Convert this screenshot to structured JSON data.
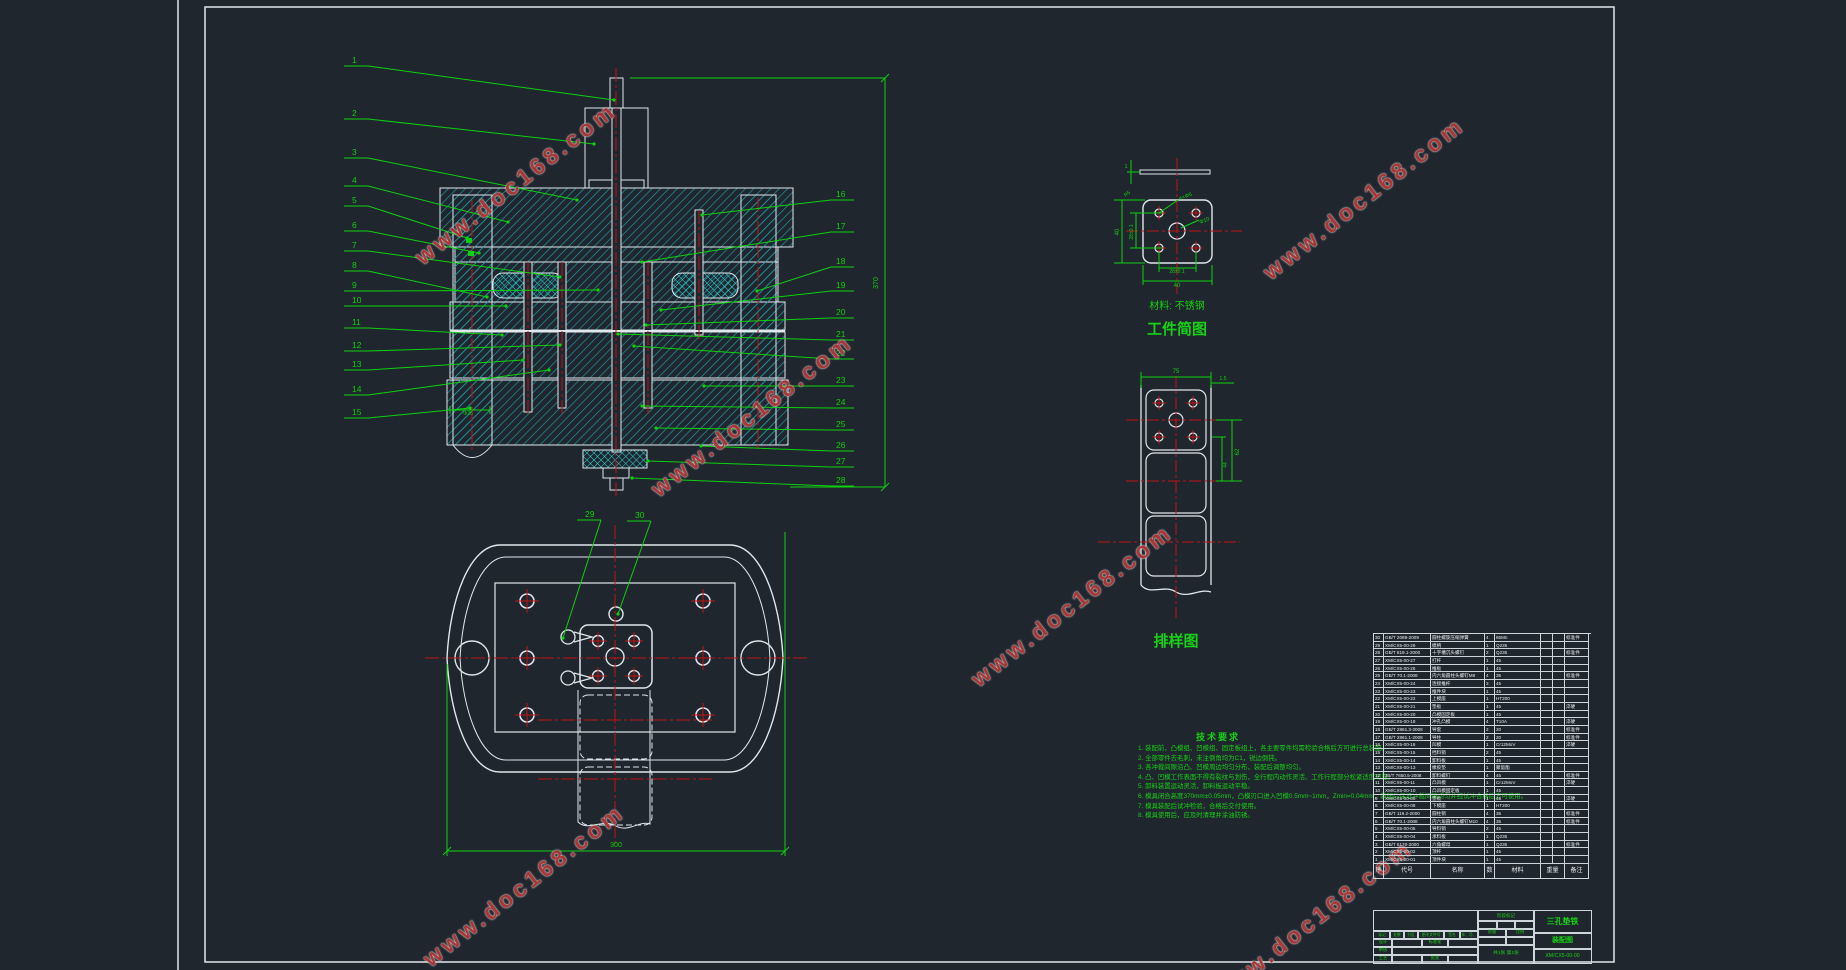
{
  "colors": {
    "bg": "#20262e",
    "line_white": "#dfe7ec",
    "annot_green": "#0ed10e",
    "center_red": "#c01414",
    "hatch_teal": "#1d97a3",
    "hatch_cyan": "#2fd8dc",
    "watermark_red": "#a83838"
  },
  "watermark": {
    "text": "www.doc168.com",
    "positions": [
      {
        "x": 392,
        "y": 170,
        "rot": -38
      },
      {
        "x": 1240,
        "y": 185,
        "rot": -38
      },
      {
        "x": 628,
        "y": 402,
        "rot": -38
      },
      {
        "x": 948,
        "y": 592,
        "rot": -38
      },
      {
        "x": 400,
        "y": 872,
        "rot": -38
      },
      {
        "x": 1188,
        "y": 908,
        "rot": -38
      }
    ]
  },
  "views": {
    "workpiece": {
      "material_note": "材料: 不锈钢",
      "title": "工件简图"
    },
    "layout": {
      "title": "排样图"
    }
  },
  "leaders": {
    "left": [
      {
        "n": "1",
        "lx": 352,
        "ly": 63,
        "tx": 614,
        "ty": 100
      },
      {
        "n": "2",
        "lx": 352,
        "ly": 116,
        "tx": 594,
        "ty": 144
      },
      {
        "n": "3",
        "lx": 352,
        "ly": 155,
        "tx": 577,
        "ty": 200
      },
      {
        "n": "4",
        "lx": 352,
        "ly": 183,
        "tx": 508,
        "ty": 222
      },
      {
        "n": "5",
        "lx": 352,
        "ly": 203,
        "tx": 467,
        "ty": 238
      },
      {
        "n": "6",
        "lx": 352,
        "ly": 228,
        "tx": 479,
        "ty": 253
      },
      {
        "n": "7",
        "lx": 352,
        "ly": 248,
        "tx": 560,
        "ty": 277
      },
      {
        "n": "8",
        "lx": 352,
        "ly": 268,
        "tx": 487,
        "ty": 297
      },
      {
        "n": "9",
        "lx": 352,
        "ly": 288,
        "tx": 598,
        "ty": 290
      },
      {
        "n": "10",
        "lx": 352,
        "ly": 303,
        "tx": 506,
        "ty": 306
      },
      {
        "n": "11",
        "lx": 352,
        "ly": 325,
        "tx": 502,
        "ty": 335
      },
      {
        "n": "12",
        "lx": 352,
        "ly": 348,
        "tx": 560,
        "ty": 345
      },
      {
        "n": "13",
        "lx": 352,
        "ly": 367,
        "tx": 523,
        "ty": 360
      },
      {
        "n": "14",
        "lx": 352,
        "ly": 392,
        "tx": 549,
        "ty": 370
      },
      {
        "n": "15",
        "lx": 352,
        "ly": 415,
        "tx": 470,
        "ty": 408
      }
    ],
    "right": [
      {
        "n": "16",
        "lx": 836,
        "ly": 197,
        "tx": 702,
        "ty": 215
      },
      {
        "n": "17",
        "lx": 836,
        "ly": 229,
        "tx": 642,
        "ty": 262
      },
      {
        "n": "18",
        "lx": 836,
        "ly": 264,
        "tx": 757,
        "ty": 291
      },
      {
        "n": "19",
        "lx": 836,
        "ly": 288,
        "tx": 661,
        "ty": 310
      },
      {
        "n": "20",
        "lx": 836,
        "ly": 315,
        "tx": 646,
        "ty": 325
      },
      {
        "n": "21",
        "lx": 836,
        "ly": 337,
        "tx": 618,
        "ty": 334
      },
      {
        "n": "22",
        "lx": 836,
        "ly": 356,
        "tx": 634,
        "ty": 346
      },
      {
        "n": "23",
        "lx": 836,
        "ly": 383,
        "tx": 704,
        "ty": 386
      },
      {
        "n": "24",
        "lx": 836,
        "ly": 405,
        "tx": 642,
        "ty": 406
      },
      {
        "n": "25",
        "lx": 836,
        "ly": 427,
        "tx": 656,
        "ty": 428
      },
      {
        "n": "26",
        "lx": 836,
        "ly": 448,
        "tx": 701,
        "ty": 446
      },
      {
        "n": "27",
        "lx": 836,
        "ly": 464,
        "tx": 648,
        "ty": 461
      },
      {
        "n": "28",
        "lx": 836,
        "ly": 483,
        "tx": 632,
        "ty": 478
      }
    ],
    "plan": [
      {
        "n": "29",
        "lx": 585,
        "ly": 517,
        "tx": 563,
        "ty": 638
      },
      {
        "n": "30",
        "lx": 635,
        "ly": 518,
        "tx": 618,
        "ty": 614
      }
    ]
  },
  "dims": [
    {
      "text": "370",
      "x": 878,
      "y": 283,
      "rot": -90,
      "size": 7
    },
    {
      "text": "300",
      "x": 616,
      "y": 847,
      "rot": 0,
      "size": 7
    },
    {
      "text": "40",
      "x": 1177,
      "y": 287,
      "rot": 0,
      "size": 6
    },
    {
      "text": "28±0.1",
      "x": 1177,
      "y": 273,
      "rot": 0,
      "size": 5
    },
    {
      "text": "40",
      "x": 1119,
      "y": 232,
      "rot": -90,
      "size": 6
    },
    {
      "text": "28±0.1",
      "x": 1133,
      "y": 232,
      "rot": -90,
      "size": 5
    },
    {
      "text": "4×Φ5",
      "x": 1186,
      "y": 198,
      "rot": -22,
      "size": 5.5
    },
    {
      "text": "Φ10",
      "x": 1205,
      "y": 222,
      "rot": -22,
      "size": 5.5
    },
    {
      "text": "R5",
      "x": 1128,
      "y": 195,
      "rot": -38,
      "size": 5
    },
    {
      "text": "1",
      "x": 1126,
      "y": 168,
      "rot": 0,
      "size": 5.5
    },
    {
      "text": "75",
      "x": 1176,
      "y": 373,
      "rot": 0,
      "size": 6
    },
    {
      "text": "1.5",
      "x": 1223,
      "y": 380,
      "rot": 0,
      "size": 5
    },
    {
      "text": "62",
      "x": 1239,
      "y": 452,
      "rot": -90,
      "size": 6
    },
    {
      "text": "44",
      "x": 1227,
      "y": 465,
      "rot": -90,
      "size": 5
    },
    {
      "text": "Φ25",
      "x": 468,
      "y": 415,
      "rot": 0,
      "size": 5
    }
  ],
  "tech_requirements": {
    "title": "技术要求",
    "items": [
      "1. 装配前，凸模组、凹模组、固定板组上，各主要零件均需检验合格后方可进行总装配。",
      "2. 全部零件去毛刺，未注倒角均为C1，锐边倒钝。",
      "3. 各冲裁间隙沿凸、凹模周边均匀分布，装配后调整均匀。",
      "4. 凸、凹模工作表面不得有裂纹与划伤，全行程内动作灵活、工作行程部分松紧适度可靠。",
      "5. 卸料装置运动灵活，卸料板运动平稳。",
      "6. 模具闭合高度370mm±0.05mm，凸模刃口进入凹模0.5mm~1mm，Zmin=0.04mm，装配后保证冲裁间隙均匀并经试冲合格后方可使用。",
      "7. 模具装配后试冲检验，合格后交付使用。",
      "8. 模具使用后，应及时清理并涂油防锈。"
    ]
  },
  "bom": {
    "headers": {
      "no": "序号",
      "code": "代号",
      "name": "名称",
      "qty": "数量",
      "mat": "材料",
      "weight": "重量",
      "remark": "备注"
    },
    "rows": [
      {
        "no": "30",
        "code": "GB/T 2089-2009",
        "name": "圆柱螺旋压缩弹簧",
        "qty": "4",
        "mat": "65Mn",
        "remark": "标准件"
      },
      {
        "no": "29",
        "code": "XM/CX5-00-29",
        "name": "模柄",
        "qty": "1",
        "mat": "Q235",
        "remark": ""
      },
      {
        "no": "28",
        "code": "GB/T 819.1-2000",
        "name": "十字槽沉头螺钉",
        "qty": "2",
        "mat": "Q235",
        "remark": "标准件"
      },
      {
        "no": "27",
        "code": "XM/CX5-00-27",
        "name": "打杆",
        "qty": "1",
        "mat": "45",
        "remark": ""
      },
      {
        "no": "26",
        "code": "XM/CX5-00-26",
        "name": "推板",
        "qty": "1",
        "mat": "45",
        "remark": ""
      },
      {
        "no": "25",
        "code": "GB/T 70.1-2008",
        "name": "内六角圆柱头螺钉M8",
        "qty": "4",
        "mat": "35",
        "remark": "标准件"
      },
      {
        "no": "24",
        "code": "XM/CX5-00-24",
        "name": "连接推杆",
        "qty": "3",
        "mat": "45",
        "remark": ""
      },
      {
        "no": "23",
        "code": "XM/CX5-00-23",
        "name": "推件块",
        "qty": "1",
        "mat": "45",
        "remark": ""
      },
      {
        "no": "22",
        "code": "XM/CX5-00-22",
        "name": "上模座",
        "qty": "1",
        "mat": "HT200",
        "remark": ""
      },
      {
        "no": "21",
        "code": "XM/CX5-00-21",
        "name": "垫板",
        "qty": "1",
        "mat": "45",
        "remark": "淬硬"
      },
      {
        "no": "20",
        "code": "XM/CX5-00-20",
        "name": "凸模固定板",
        "qty": "1",
        "mat": "45",
        "remark": ""
      },
      {
        "no": "19",
        "code": "XM/CX5-00-19",
        "name": "冲孔凸模",
        "qty": "4",
        "mat": "T10A",
        "remark": "淬硬"
      },
      {
        "no": "18",
        "code": "GB/T 2861.3-2008",
        "name": "导套",
        "qty": "2",
        "mat": "20",
        "remark": "标准件"
      },
      {
        "no": "17",
        "code": "GB/T 2861.1-2008",
        "name": "导柱",
        "qty": "2",
        "mat": "20",
        "remark": "标准件"
      },
      {
        "no": "16",
        "code": "XM/CX5-00-16",
        "name": "凹模",
        "qty": "1",
        "mat": "Cr12MoV",
        "remark": "淬硬"
      },
      {
        "no": "15",
        "code": "XM/CX5-00-15",
        "name": "挡料销",
        "qty": "2",
        "mat": "45",
        "remark": ""
      },
      {
        "no": "14",
        "code": "XM/CX5-00-14",
        "name": "卸料板",
        "qty": "1",
        "mat": "45",
        "remark": ""
      },
      {
        "no": "13",
        "code": "XM/CX5-00-13",
        "name": "橡胶垫",
        "qty": "1",
        "mat": "聚氨酯",
        "remark": ""
      },
      {
        "no": "12",
        "code": "JB/T 7650.5-2008",
        "name": "卸料螺钉",
        "qty": "4",
        "mat": "45",
        "remark": "标准件"
      },
      {
        "no": "11",
        "code": "XM/CX5-00-11",
        "name": "凸凹模",
        "qty": "1",
        "mat": "Cr12MoV",
        "remark": "淬硬"
      },
      {
        "no": "10",
        "code": "XM/CX5-00-10",
        "name": "凸凹模固定板",
        "qty": "1",
        "mat": "45",
        "remark": ""
      },
      {
        "no": "9",
        "code": "XM/CX5-00-09",
        "name": "垫板",
        "qty": "1",
        "mat": "45",
        "remark": "淬硬"
      },
      {
        "no": "8",
        "code": "XM/CX5-00-08",
        "name": "下模座",
        "qty": "1",
        "mat": "HT200",
        "remark": ""
      },
      {
        "no": "7",
        "code": "GB/T 119.2-2000",
        "name": "圆柱销",
        "qty": "4",
        "mat": "35",
        "remark": "标准件"
      },
      {
        "no": "6",
        "code": "GB/T 70.1-2008",
        "name": "内六角圆柱头螺钉M10",
        "qty": "4",
        "mat": "35",
        "remark": "标准件"
      },
      {
        "no": "5",
        "code": "XM/CX5-00-05",
        "name": "导料销",
        "qty": "2",
        "mat": "45",
        "remark": ""
      },
      {
        "no": "4",
        "code": "XM/CX5-00-04",
        "name": "承料板",
        "qty": "1",
        "mat": "Q235",
        "remark": ""
      },
      {
        "no": "3",
        "code": "GB/T 6170-2000",
        "name": "六角螺母",
        "qty": "1",
        "mat": "Q235",
        "remark": "标准件"
      },
      {
        "no": "2",
        "code": "XM/CX5-00-02",
        "name": "顶杆",
        "qty": "1",
        "mat": "45",
        "remark": ""
      },
      {
        "no": "1",
        "code": "XM/CX5-00-01",
        "name": "顶件块",
        "qty": "1",
        "mat": "45",
        "remark": ""
      }
    ]
  },
  "title_block": {
    "product": "三孔垫铁",
    "doc_type": "装配图",
    "drawing_no": "XM/CX5-00-00",
    "rev_labels": [
      "标记",
      "处数",
      "分区",
      "更改文件号",
      "签名",
      "年、月、日"
    ],
    "role_labels": {
      "design": "设计",
      "check": "审核",
      "process": "工艺",
      "std": "标准化",
      "approve": "批准"
    },
    "misc_labels": {
      "stage": "阶段标记",
      "weight": "质量",
      "scale": "比例",
      "sheets": "共1张 第1张"
    }
  }
}
